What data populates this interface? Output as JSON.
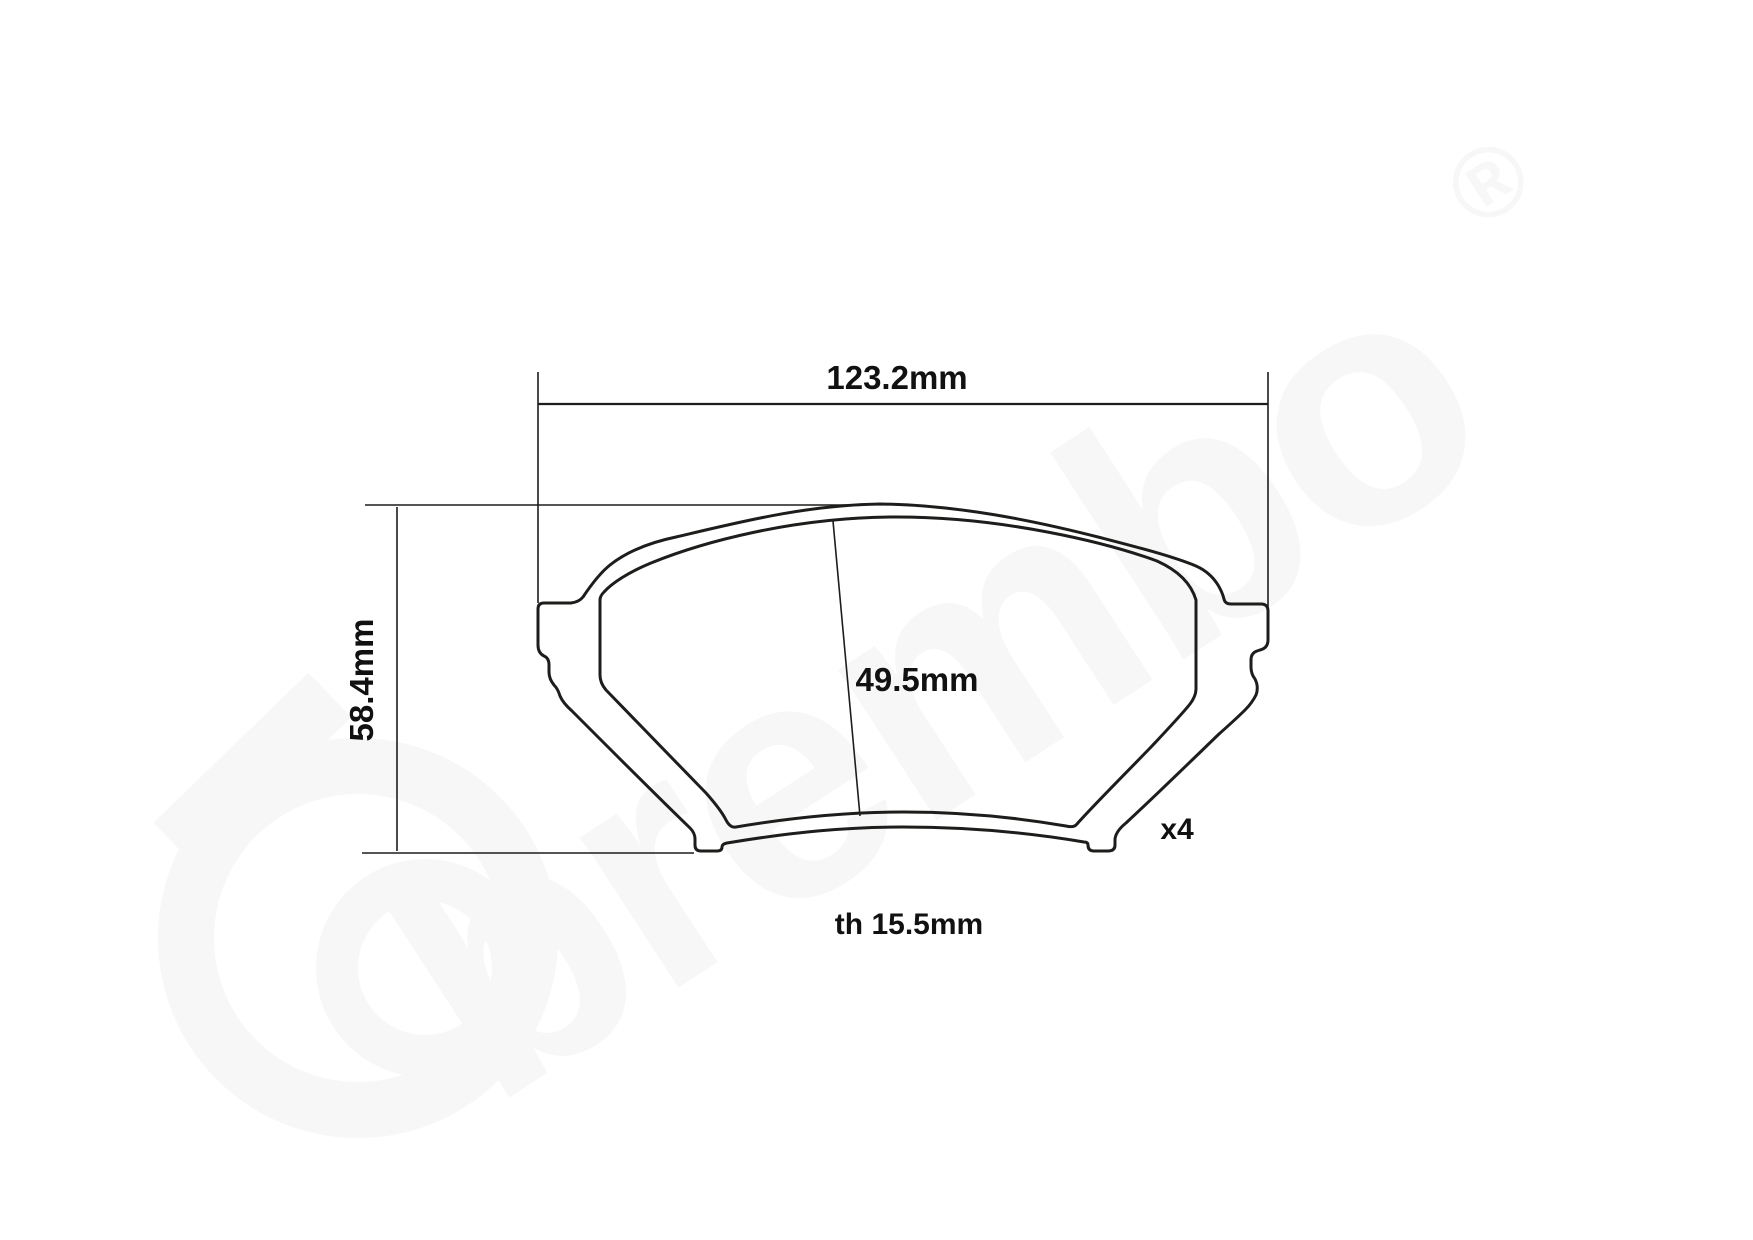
{
  "page": {
    "background": "#ffffff"
  },
  "drawing": {
    "type": "brake-pad-technical-drawing",
    "line_color": "#1d1d1b",
    "labels": {
      "width": "123.2mm",
      "height": "58.4mm",
      "friction_height": "49.5mm",
      "thickness": "th 15.5mm",
      "quantity": "x4"
    },
    "watermark": {
      "text": "brembo",
      "registered": "®",
      "color": "#f7f7f7"
    }
  }
}
